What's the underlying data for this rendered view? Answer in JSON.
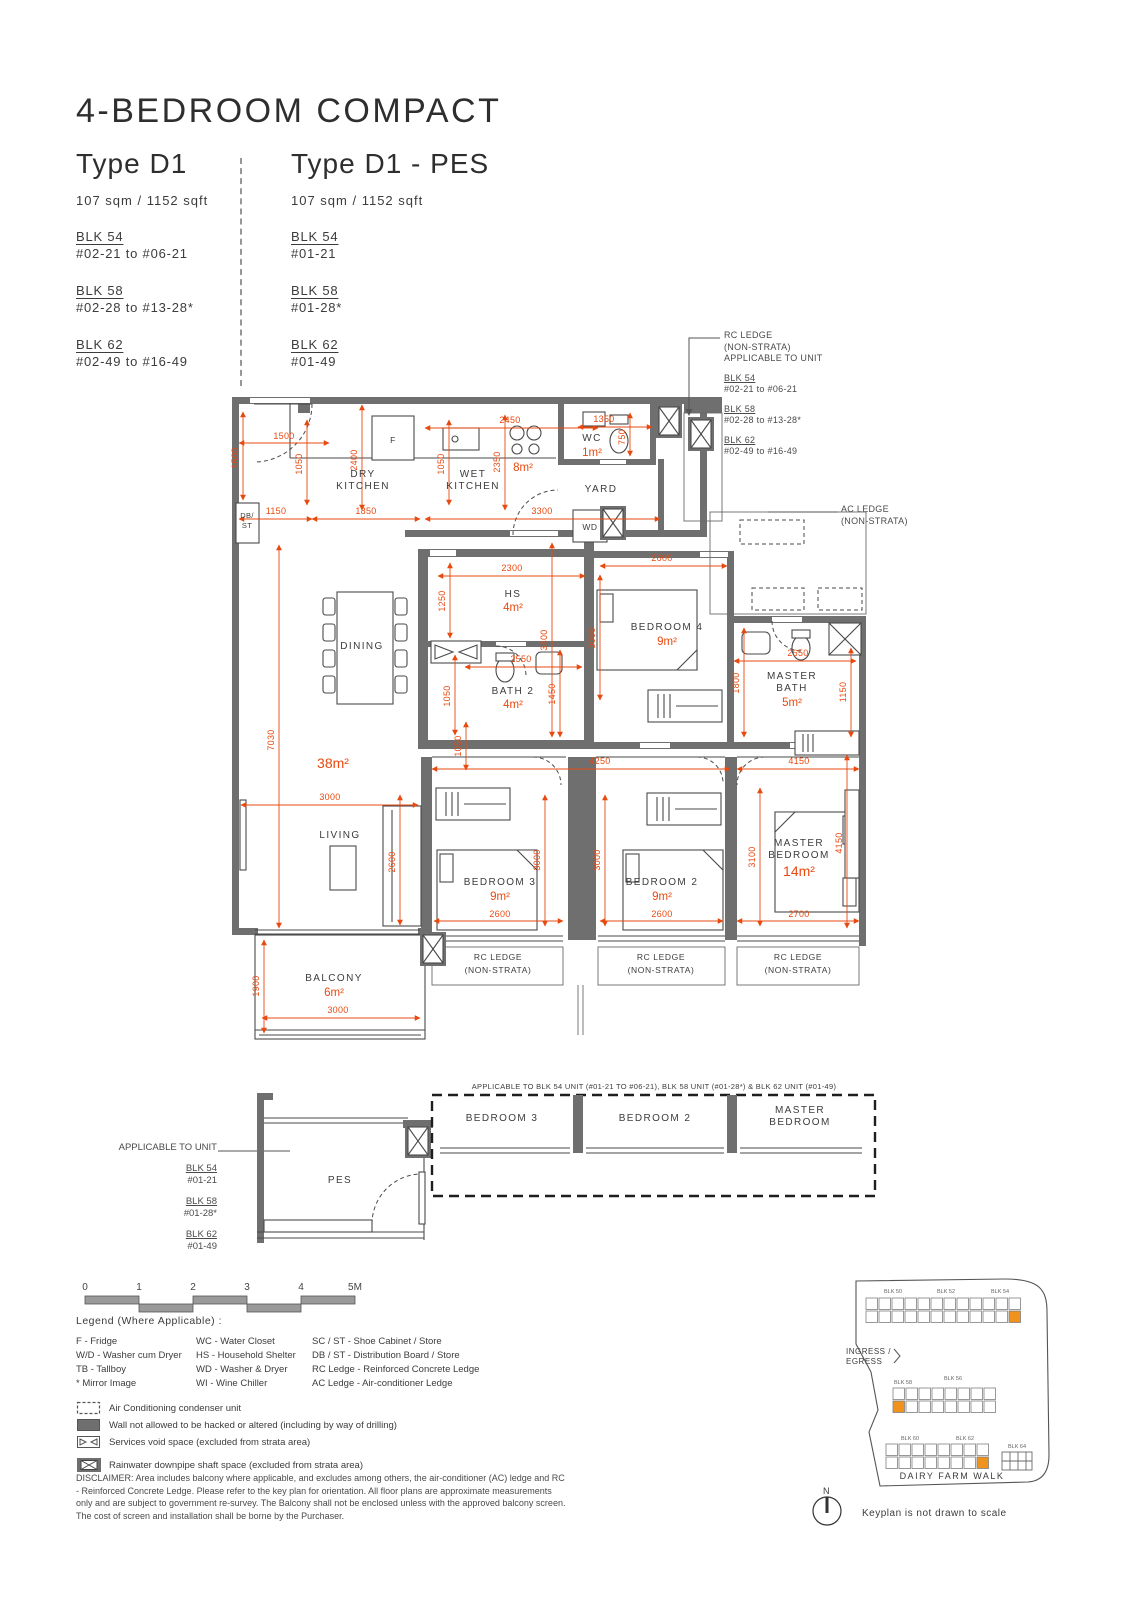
{
  "header": {
    "title": "4-BEDROOM COMPACT",
    "types": [
      {
        "name": "Type D1",
        "area": "107 sqm / 1152 sqft",
        "blocks": [
          [
            "BLK 54",
            "#02-21 to #06-21"
          ],
          [
            "BLK 58",
            "#02-28 to #13-28*"
          ],
          [
            "BLK 62",
            "#02-49 to #16-49"
          ]
        ]
      },
      {
        "name": "Type D1 - PES",
        "area": "107 sqm / 1152 sqft",
        "blocks": [
          [
            "BLK 54",
            "#01-21"
          ],
          [
            "BLK 58",
            "#01-28*"
          ],
          [
            "BLK 62",
            "#01-49"
          ]
        ]
      }
    ]
  },
  "rc_note": {
    "l1": "RC LEDGE",
    "l2": "(NON-STRATA)",
    "l3": "APPLICABLE TO UNIT",
    "blocks": [
      [
        "BLK 54",
        "#02-21 to #06-21"
      ],
      [
        "BLK 58",
        "#02-28 to #13-28*"
      ],
      [
        "BLK 62",
        "#02-49 to #16-49"
      ]
    ]
  },
  "ac_note": [
    "AC LEDGE",
    "(NON-STRATA)"
  ],
  "pes_note": {
    "title": "APPLICABLE TO UNIT",
    "blocks": [
      [
        "BLK 54",
        "#01-21"
      ],
      [
        "BLK 58",
        "#01-28*"
      ],
      [
        "BLK 62",
        "#01-49"
      ]
    ]
  },
  "plan": {
    "texts": [
      {
        "t": "1500",
        "x": 284,
        "y": 439,
        "c": "dim",
        "l": [
          239,
          443,
          329,
          443
        ]
      },
      {
        "t": "1500",
        "x": 238,
        "y": 458,
        "c": "dim",
        "r": 1,
        "l": [
          243,
          412,
          243,
          500
        ]
      },
      {
        "t": "1050",
        "x": 302,
        "y": 464,
        "c": "dim",
        "r": 1,
        "l": [
          307,
          420,
          307,
          505
        ]
      },
      {
        "t": "2400",
        "x": 357,
        "y": 460,
        "c": "dim",
        "r": 1,
        "l": [
          362,
          405,
          362,
          510
        ]
      },
      {
        "t": "2450",
        "x": 510,
        "y": 423,
        "c": "dim",
        "l": [
          425,
          428,
          598,
          428
        ]
      },
      {
        "t": "1050",
        "x": 444,
        "y": 464,
        "c": "dim",
        "r": 1,
        "l": [
          449,
          420,
          449,
          505
        ]
      },
      {
        "t": "2350",
        "x": 500,
        "y": 462,
        "c": "dim",
        "r": 1,
        "l": [
          505,
          415,
          505,
          510
        ]
      },
      {
        "t": "1350",
        "x": 604,
        "y": 422,
        "c": "dim",
        "l": [
          578,
          427,
          652,
          427
        ]
      },
      {
        "t": "750",
        "x": 625,
        "y": 437,
        "c": "dim",
        "r": 1,
        "l": [
          630,
          413,
          630,
          456
        ]
      },
      {
        "t": "1150",
        "x": 276,
        "y": 514,
        "c": "dim",
        "l": [
          239,
          519,
          312,
          519
        ]
      },
      {
        "t": "1850",
        "x": 366,
        "y": 514,
        "c": "dim",
        "l": [
          312,
          519,
          420,
          519
        ]
      },
      {
        "t": "3300",
        "x": 542,
        "y": 514,
        "c": "dim",
        "l": [
          425,
          519,
          660,
          519
        ]
      },
      {
        "t": "8m²",
        "x": 523,
        "y": 471,
        "c": "ar"
      },
      {
        "t": "DRY",
        "x": 363,
        "y": 477,
        "c": "rm"
      },
      {
        "t": "KITCHEN",
        "x": 363,
        "y": 489,
        "c": "rm"
      },
      {
        "t": "WET",
        "x": 473,
        "y": 477,
        "c": "rm"
      },
      {
        "t": "KITCHEN",
        "x": 473,
        "y": 489,
        "c": "rm"
      },
      {
        "t": "WC",
        "x": 592,
        "y": 441,
        "c": "rm"
      },
      {
        "t": "1m²",
        "x": 592,
        "y": 456,
        "c": "ar"
      },
      {
        "t": "YARD",
        "x": 601,
        "y": 492,
        "c": "rm"
      },
      {
        "t": "WD",
        "x": 590,
        "y": 530,
        "c": "rm2"
      },
      {
        "t": "F",
        "x": 393,
        "y": 443,
        "c": "rm2"
      },
      {
        "t": "DB/",
        "x": 247,
        "y": 518,
        "c": "tn"
      },
      {
        "t": "ST",
        "x": 247,
        "y": 528,
        "c": "tn"
      },
      {
        "t": "2300",
        "x": 512,
        "y": 571,
        "c": "dim",
        "l": [
          438,
          576,
          585,
          576
        ]
      },
      {
        "t": "1250",
        "x": 445,
        "y": 601,
        "c": "dim",
        "r": 1,
        "l": [
          450,
          563,
          450,
          638
        ]
      },
      {
        "t": "3400",
        "x": 547,
        "y": 640,
        "c": "dim",
        "r": 1,
        "l": [
          552,
          543,
          552,
          737
        ]
      },
      {
        "t": "HS",
        "x": 513,
        "y": 597,
        "c": "rm"
      },
      {
        "t": "4m²",
        "x": 513,
        "y": 611,
        "c": "ar"
      },
      {
        "t": "2600",
        "x": 662,
        "y": 561,
        "c": "dim",
        "l": [
          600,
          566,
          727,
          566
        ]
      },
      {
        "t": "3000",
        "x": 595,
        "y": 638,
        "c": "dim",
        "r": 1,
        "l": [
          600,
          575,
          600,
          700
        ]
      },
      {
        "t": "BEDROOM 4",
        "x": 667,
        "y": 630,
        "c": "rm"
      },
      {
        "t": "9m²",
        "x": 667,
        "y": 645,
        "c": "ar"
      },
      {
        "t": "2550",
        "x": 521,
        "y": 662,
        "c": "dim",
        "l": [
          465,
          667,
          582,
          667
        ]
      },
      {
        "t": "1050",
        "x": 450,
        "y": 696,
        "c": "dim",
        "r": 1,
        "l": [
          455,
          655,
          455,
          735
        ]
      },
      {
        "t": "1450",
        "x": 555,
        "y": 694,
        "c": "dim",
        "r": 1,
        "l": [
          560,
          650,
          560,
          737
        ]
      },
      {
        "t": "BATH 2",
        "x": 513,
        "y": 694,
        "c": "rm"
      },
      {
        "t": "4m²",
        "x": 513,
        "y": 708,
        "c": "ar"
      },
      {
        "t": "1800",
        "x": 739,
        "y": 683,
        "c": "dim",
        "r": 1,
        "l": [
          744,
          628,
          744,
          737
        ]
      },
      {
        "t": "2650",
        "x": 798,
        "y": 656,
        "c": "dim",
        "l": [
          734,
          661,
          856,
          661
        ]
      },
      {
        "t": "1150",
        "x": 846,
        "y": 692,
        "c": "dim",
        "r": 1,
        "l": [
          851,
          648,
          851,
          737
        ]
      },
      {
        "t": "MASTER",
        "x": 792,
        "y": 679,
        "c": "rm"
      },
      {
        "t": "BATH",
        "x": 792,
        "y": 691,
        "c": "rm"
      },
      {
        "t": "5m²",
        "x": 792,
        "y": 706,
        "c": "ar"
      },
      {
        "t": "7030",
        "x": 274,
        "y": 740,
        "c": "dim",
        "r": 1,
        "l": [
          279,
          545,
          279,
          928
        ]
      },
      {
        "t": "38m²",
        "x": 333,
        "y": 768,
        "c": "arb"
      },
      {
        "t": "DINING",
        "x": 362,
        "y": 649,
        "c": "rm"
      },
      {
        "t": "3000",
        "x": 330,
        "y": 800,
        "c": "dim",
        "l": [
          241,
          805,
          418,
          805
        ]
      },
      {
        "t": "2600",
        "x": 395,
        "y": 862,
        "c": "dim",
        "r": 1,
        "l": [
          400,
          795,
          400,
          925
        ]
      },
      {
        "t": "LIVING",
        "x": 340,
        "y": 838,
        "c": "rm"
      },
      {
        "t": "1050",
        "x": 461,
        "y": 746,
        "c": "dim",
        "r": 1,
        "l": [
          466,
          722,
          466,
          770
        ]
      },
      {
        "t": "4250",
        "x": 600,
        "y": 764,
        "c": "dim",
        "l": [
          432,
          769,
          730,
          769
        ]
      },
      {
        "t": "4150",
        "x": 799,
        "y": 764,
        "c": "dim",
        "l": [
          737,
          769,
          859,
          769
        ]
      },
      {
        "t": "3000",
        "x": 540,
        "y": 860,
        "c": "dim",
        "r": 1,
        "l": [
          545,
          795,
          545,
          926
        ]
      },
      {
        "t": "3000",
        "x": 600,
        "y": 860,
        "c": "dim",
        "r": 1,
        "l": [
          605,
          795,
          605,
          926
        ]
      },
      {
        "t": "3100",
        "x": 755,
        "y": 857,
        "c": "dim",
        "r": 1,
        "l": [
          760,
          788,
          760,
          926
        ]
      },
      {
        "t": "4150",
        "x": 842,
        "y": 843,
        "c": "dim",
        "r": 1,
        "l": [
          847,
          755,
          847,
          928
        ]
      },
      {
        "t": "BEDROOM 3",
        "x": 500,
        "y": 885,
        "c": "rm"
      },
      {
        "t": "9m²",
        "x": 500,
        "y": 900,
        "c": "ar"
      },
      {
        "t": "BEDROOM 2",
        "x": 662,
        "y": 885,
        "c": "rm"
      },
      {
        "t": "9m²",
        "x": 662,
        "y": 900,
        "c": "ar"
      },
      {
        "t": "MASTER",
        "x": 799,
        "y": 846,
        "c": "rm"
      },
      {
        "t": "BEDROOM",
        "x": 799,
        "y": 858,
        "c": "rm"
      },
      {
        "t": "14m²",
        "x": 799,
        "y": 876,
        "c": "arb"
      },
      {
        "t": "2600",
        "x": 500,
        "y": 917,
        "c": "dim",
        "l": [
          434,
          921,
          563,
          921
        ]
      },
      {
        "t": "2600",
        "x": 662,
        "y": 917,
        "c": "dim",
        "l": [
          600,
          921,
          723,
          921
        ]
      },
      {
        "t": "2700",
        "x": 799,
        "y": 917,
        "c": "dim",
        "l": [
          737,
          921,
          859,
          921
        ]
      },
      {
        "t": "1900",
        "x": 259,
        "y": 986,
        "c": "dim",
        "r": 1,
        "l": [
          264,
          940,
          264,
          1033
        ]
      },
      {
        "t": "BALCONY",
        "x": 334,
        "y": 981,
        "c": "rm"
      },
      {
        "t": "6m²",
        "x": 334,
        "y": 996,
        "c": "ar"
      },
      {
        "t": "3000",
        "x": 338,
        "y": 1013,
        "c": "dim",
        "l": [
          262,
          1018,
          420,
          1018
        ]
      },
      {
        "t": "RC LEDGE",
        "x": 498,
        "y": 960,
        "c": "rm2"
      },
      {
        "t": "(NON-STRATA)",
        "x": 498,
        "y": 973,
        "c": "rm2"
      },
      {
        "t": "RC LEDGE",
        "x": 661,
        "y": 960,
        "c": "rm2"
      },
      {
        "t": "(NON-STRATA)",
        "x": 661,
        "y": 973,
        "c": "rm2"
      },
      {
        "t": "RC LEDGE",
        "x": 798,
        "y": 960,
        "c": "rm2"
      },
      {
        "t": "(NON-STRATA)",
        "x": 798,
        "y": 973,
        "c": "rm2"
      },
      {
        "t": "PES",
        "x": 340,
        "y": 1183,
        "c": "rm"
      },
      {
        "t": "BEDROOM 3",
        "x": 502,
        "y": 1121,
        "c": "rm"
      },
      {
        "t": "BEDROOM 2",
        "x": 655,
        "y": 1121,
        "c": "rm"
      },
      {
        "t": "MASTER",
        "x": 800,
        "y": 1113,
        "c": "rm"
      },
      {
        "t": "BEDROOM",
        "x": 800,
        "y": 1125,
        "c": "rm"
      },
      {
        "t": "APPLICABLE TO BLK 54 UNIT (#01-21 TO #06-21), BLK 58 UNIT (#01-28*) & BLK 62 UNIT (#01-49)",
        "x": 654,
        "y": 1089,
        "c": "tn"
      }
    ]
  },
  "scalebar": {
    "ticks": [
      "0",
      "1",
      "2",
      "3",
      "4",
      "5M"
    ]
  },
  "legend": {
    "title": "Legend (Where Applicable) :",
    "col1": [
      "F - Fridge",
      "W/D - Washer cum Dryer",
      "TB - Tallboy",
      "* Mirror Image"
    ],
    "col2": [
      "WC - Water Closet",
      "HS - Household Shelter",
      "WD - Washer & Dryer",
      "WI - Wine Chiller"
    ],
    "col3": [
      "SC / ST - Shoe Cabinet / Store",
      "DB / ST - Distribution Board / Store",
      "RC Ledge - Reinforced Concrete Ledge",
      "AC Ledge - Air-conditioner Ledge"
    ],
    "symbols": [
      "Air Conditioning condenser unit",
      "Wall not allowed to be hacked or altered (including by way of drilling)",
      "Services void space (excluded from strata area)",
      "Rainwater downpipe shaft space (excluded from strata area)"
    ]
  },
  "disclaimer": "DISCLAIMER: Area includes balcony where applicable, and excludes among others, the air-conditioner (AC) ledge and RC - Reinforced Concrete Ledge. Please refer to the key plan for orientation. All floor plans are approximate measurements only and are subject to government re-survey. The Balcony shall not be enclosed unless with the approved balcony screen. The cost of screen and installation shall be borne by the Purchaser.",
  "keyplan": {
    "clusters": [
      {
        "x": 866,
        "y": 1298,
        "cols": 12,
        "rows": 2,
        "s": 13,
        "hr": 1,
        "hc": 11
      },
      {
        "x": 893,
        "y": 1388,
        "cols": 8,
        "rows": 2,
        "s": 13,
        "hr": 1,
        "hc": 0
      },
      {
        "x": 886,
        "y": 1444,
        "cols": 8,
        "rows": 2,
        "s": 13,
        "hr": 1,
        "hc": 7
      }
    ],
    "texts": [
      {
        "t": "BLK 50",
        "x": 893,
        "y": 1293,
        "c": "kpt"
      },
      {
        "t": "BLK 52",
        "x": 946,
        "y": 1293,
        "c": "kpt"
      },
      {
        "t": "BLK 54",
        "x": 1000,
        "y": 1293,
        "c": "kpt"
      },
      {
        "t": "BLK 58",
        "x": 903,
        "y": 1384,
        "c": "kpt"
      },
      {
        "t": "BLK 56",
        "x": 953,
        "y": 1380,
        "c": "kpt"
      },
      {
        "t": "BLK 60",
        "x": 910,
        "y": 1440,
        "c": "kpt"
      },
      {
        "t": "BLK 62",
        "x": 965,
        "y": 1440,
        "c": "kpt"
      },
      {
        "t": "BLK 64",
        "x": 1017,
        "y": 1448,
        "c": "kpt"
      },
      {
        "t": "INGRESS /",
        "x": 846,
        "y": 1354,
        "c": "kpn"
      },
      {
        "t": "EGRESS",
        "x": 846,
        "y": 1364,
        "c": "kpn"
      },
      {
        "t": "DAIRY FARM WALK",
        "x": 952,
        "y": 1479,
        "c": "kp"
      },
      {
        "t": "N",
        "x": 827,
        "y": 1494,
        "c": "kp"
      },
      {
        "t": "Keyplan is not drawn to scale",
        "x": 862,
        "y": 1516,
        "c": "kpn2"
      }
    ]
  },
  "colors": {
    "dim": "#e8490f",
    "wall": "#6f6f6f",
    "highlight": "#f0931e"
  }
}
